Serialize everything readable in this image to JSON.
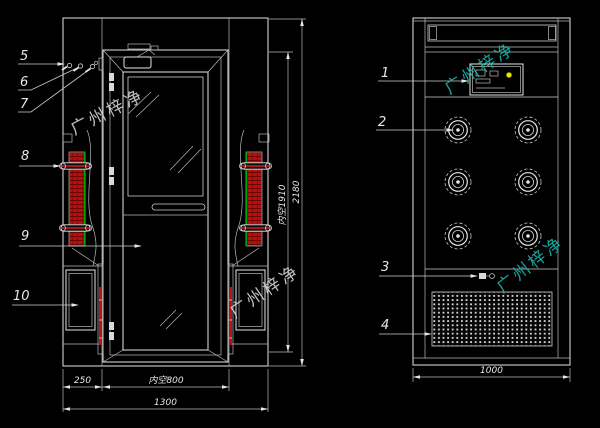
{
  "watermark": {
    "text": "广州梓净"
  },
  "front_view": {
    "callouts": {
      "c5": "5",
      "c6": "6",
      "c7": "7",
      "c8": "8",
      "c9": "9",
      "c10": "10"
    },
    "dimensions": {
      "left_section_width": "250",
      "inner_width": "内空800",
      "overall_width": "1300",
      "inner_height": "内空1910",
      "overall_height": "2180"
    }
  },
  "side_view": {
    "callouts": {
      "c1": "1",
      "c2": "2",
      "c3": "3",
      "c4": "4"
    },
    "dimensions": {
      "overall_depth": "1000"
    }
  },
  "colors": {
    "background": "#000000",
    "line": "#e6e6e6",
    "nozzle_duct_fill": "#c01212",
    "duct_edge_green": "#00a400",
    "indicator_yellow": "#f0e000",
    "watermark_cyan": "#1fb3ad",
    "watermark_light": "#d4d8d8"
  }
}
